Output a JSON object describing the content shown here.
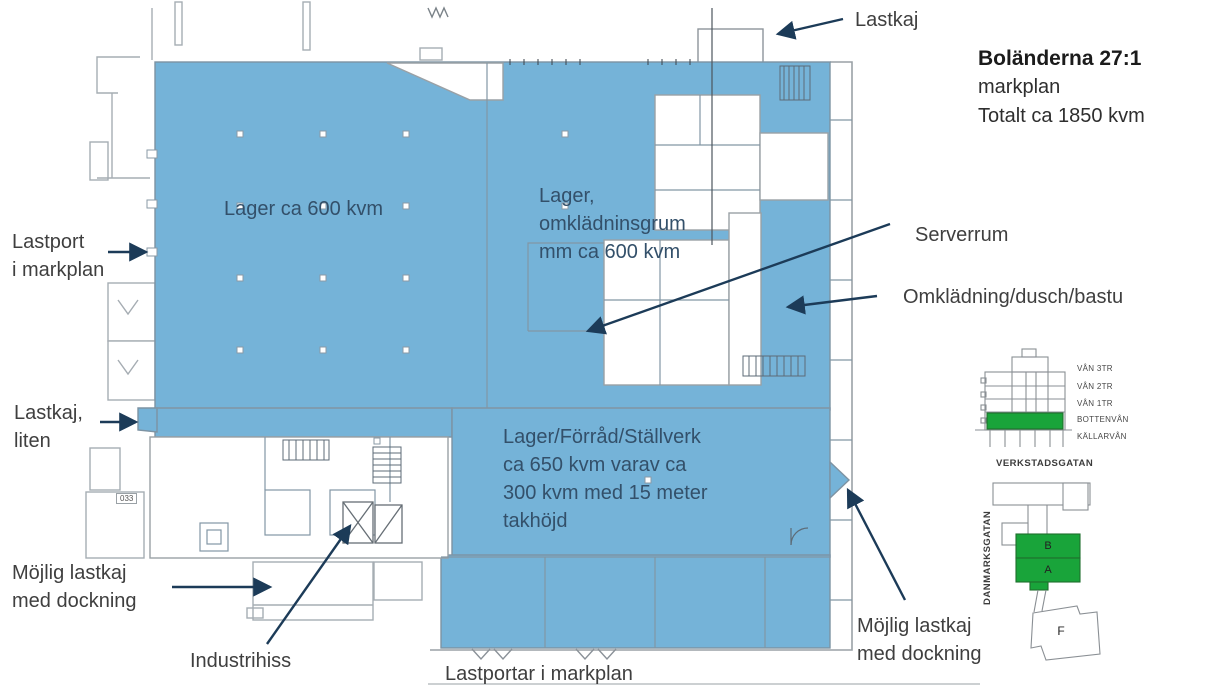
{
  "header": {
    "property_name": "Boländerna 27:1",
    "plan_name": "markplan",
    "total_area": "Totalt ca 1850 kvm"
  },
  "plan_areas": {
    "lager": "Lager ca 600 kvm",
    "lager_omkladning": {
      "l1": "Lager,",
      "l2": "omklädninsgrum",
      "l3": "mm ca 600 kvm"
    },
    "stallverk": {
      "l1": "Lager/Förråd/Ställverk",
      "l2": "ca 650 kvm varav ca",
      "l3": "300 kvm med 15 meter",
      "l4": "takhöjd"
    },
    "room_tag": "033"
  },
  "callouts": {
    "lastkaj_top": "Lastkaj",
    "lastport": {
      "l1": "Lastport",
      "l2": "i markplan"
    },
    "serverrum": "Serverrum",
    "omkladning": "Omklädning/dusch/bastu",
    "lastkaj_liten": {
      "l1": "Lastkaj,",
      "l2": "liten"
    },
    "mojlig_lastkaj_left": {
      "l1": "Möjlig lastkaj",
      "l2": "med dockning"
    },
    "industrihiss": "Industrihiss",
    "lastportar": "Lastportar i markplan",
    "mojlig_lastkaj_right": {
      "l1": "Möjlig lastkaj",
      "l2": "med dockning"
    }
  },
  "section_diagram": {
    "floors": [
      {
        "label": "VÅN 3TR",
        "highlighted": false
      },
      {
        "label": "VÅN 2TR",
        "highlighted": false
      },
      {
        "label": "VÅN 1TR",
        "highlighted": false
      },
      {
        "label": "BOTTENVÅN",
        "highlighted": true
      },
      {
        "label": "KÄLLARVÅN",
        "highlighted": false
      }
    ]
  },
  "site_map": {
    "street_top": "VERKSTADSGATAN",
    "street_left": "DANMARKSGATAN",
    "buildings": {
      "b": "B",
      "a": "A",
      "f": "F"
    }
  },
  "colors": {
    "plan_fill": "#75b3d8",
    "highlight_green": "#19a43a",
    "arrow_navy": "#1c3b58",
    "label_gray": "#3f3f3f",
    "plan_label_navy": "#33506a"
  }
}
